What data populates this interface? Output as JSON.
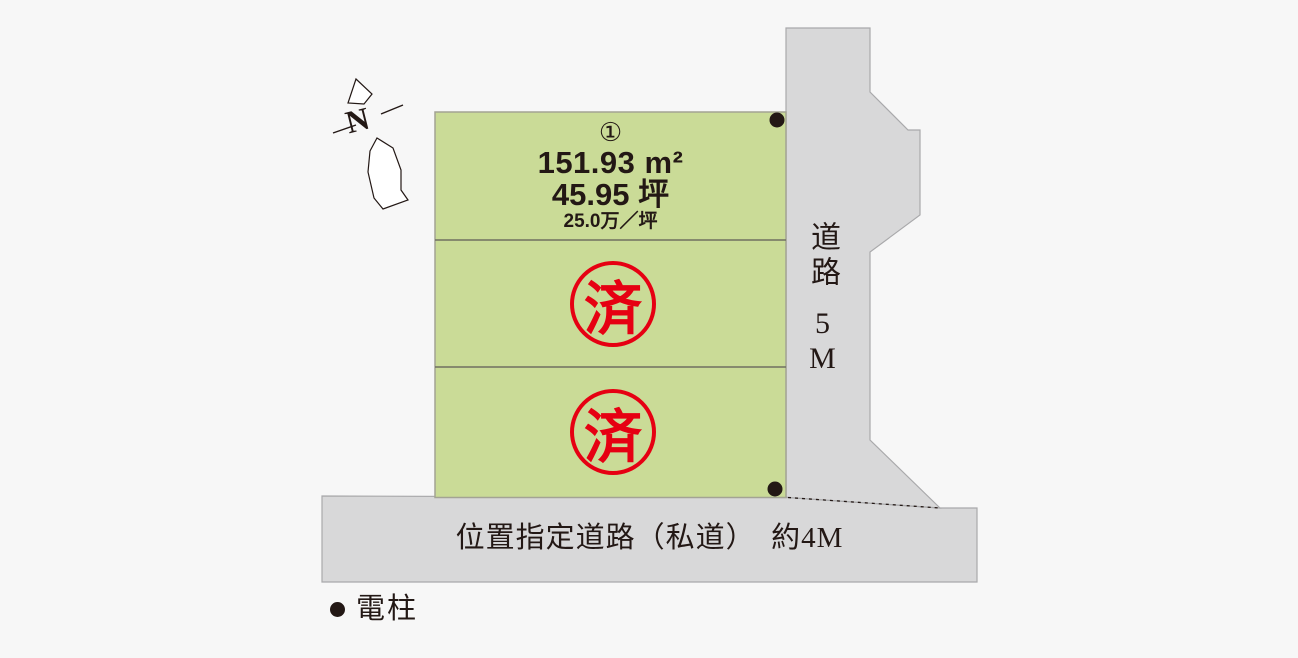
{
  "colors": {
    "background": "#f7f7f7",
    "lot-green": "#cadb97",
    "lot-border": "#a3a394",
    "divider": "#6f7061",
    "road-gray": "#d8d8d9",
    "road-border": "#a9a9ab",
    "stamp-red": "#e60012",
    "ink": "#231815"
  },
  "compass": {
    "label": "N"
  },
  "site": {
    "lots": [
      {
        "number": "①",
        "area_m2": "151.93 m²",
        "area_tsubo": "45.95 坪",
        "price_per_tsubo": "25.0万／坪"
      },
      {
        "status": "済"
      },
      {
        "status": "済"
      }
    ]
  },
  "roads": {
    "right": {
      "name": "道路",
      "width": "5M"
    },
    "bottom": {
      "label": "位置指定道路（私道）　約4M"
    }
  },
  "legend": {
    "label": "電柱"
  }
}
